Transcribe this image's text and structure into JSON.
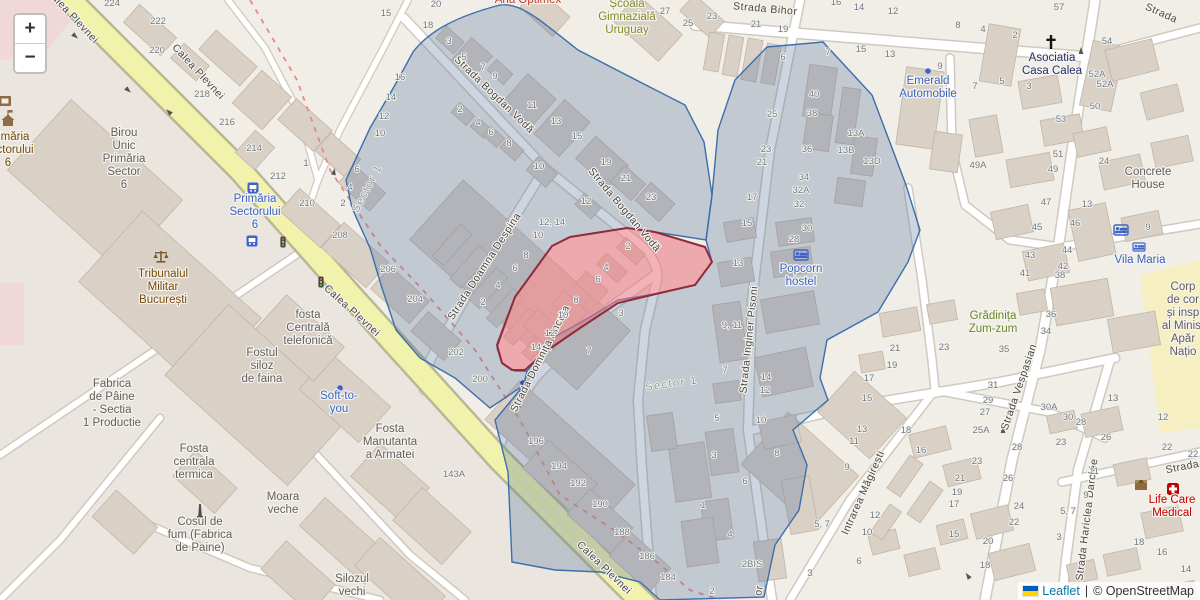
{
  "map": {
    "controls": {
      "zoom_in": "+",
      "zoom_out": "−"
    },
    "attribution": {
      "leaflet": "Leaflet",
      "separator": "|",
      "copyright": "© OpenStreetMap"
    }
  },
  "colors": {
    "selected_parcel_fill": "#e9737d",
    "selected_parcel_stroke": "#8f2b3c",
    "district_overlay_fill": "#5a739b",
    "district_overlay_stroke": "#3b6fad",
    "primary_road": "#f1f2ac",
    "link_blue": "#0078A8",
    "transit_label_blue": "#3a63c0",
    "amenity_label_brown": "#734a08",
    "health_label_red": "#bf0000"
  },
  "street_labels_format": "[text, x, y, rotation_deg]",
  "street_labels": [
    [
      "Calea Plevnei",
      70,
      18,
      47
    ],
    [
      "Calea Plevnei",
      196,
      74,
      47
    ],
    [
      "Calea Plevnei",
      350,
      313,
      42
    ],
    [
      "Calea Plevnei",
      602,
      570,
      44
    ],
    [
      "Strada Bogdan Vodă",
      492,
      97,
      44
    ],
    [
      "Strada Bogdan Vodă",
      622,
      212,
      50
    ],
    [
      "Strada Doamna Despina",
      487,
      268,
      -57
    ],
    [
      "Strada Domnița Ancuța",
      543,
      360,
      -63
    ],
    [
      "Strada Inginer Pisoni",
      752,
      340,
      -84
    ],
    [
      "Strada Bihor",
      765,
      12,
      5
    ],
    [
      "Intrarea Măgirești",
      866,
      494,
      -66
    ],
    [
      "Strada Vespasian",
      1022,
      388,
      -71
    ],
    [
      "Strada Hariclea Darclée",
      1090,
      520,
      -83
    ],
    [
      "Strada",
      1160,
      16,
      24
    ],
    [
      "Strada",
      1183,
      470,
      -11
    ],
    [
      "or",
      762,
      591,
      -80
    ]
  ],
  "area_labels_format": "[text, x, y, rotation_deg]",
  "area_labels": [
    [
      "Sector 1",
      370,
      190,
      -62
    ],
    [
      "Sector 1",
      672,
      387,
      -8
    ]
  ],
  "house_numbers_format": "[text, x, y]",
  "house_numbers": [
    [
      "224",
      112,
      6
    ],
    [
      "222",
      158,
      24
    ],
    [
      "220",
      157,
      53
    ],
    [
      "218",
      202,
      97
    ],
    [
      "216",
      227,
      125
    ],
    [
      "214",
      254,
      151
    ],
    [
      "212",
      278,
      179
    ],
    [
      "210",
      307,
      206
    ],
    [
      "208",
      340,
      238
    ],
    [
      "206",
      388,
      272
    ],
    [
      "204",
      415,
      302
    ],
    [
      "202",
      456,
      355
    ],
    [
      "200",
      480,
      382
    ],
    [
      "196",
      536,
      444
    ],
    [
      "194",
      559,
      469
    ],
    [
      "192",
      578,
      486
    ],
    [
      "190",
      600,
      507
    ],
    [
      "188",
      622,
      535
    ],
    [
      "186",
      647,
      559
    ],
    [
      "184",
      668,
      580
    ],
    [
      "15",
      386,
      16
    ],
    [
      "18",
      428,
      28
    ],
    [
      "20",
      436,
      7
    ],
    [
      "16",
      400,
      80
    ],
    [
      "14",
      391,
      100
    ],
    [
      "12",
      384,
      119
    ],
    [
      "10",
      380,
      136
    ],
    [
      "1",
      306,
      166
    ],
    [
      "6",
      357,
      172
    ],
    [
      "4",
      350,
      190
    ],
    [
      "2",
      343,
      206
    ],
    [
      "3",
      449,
      44
    ],
    [
      "5",
      464,
      60
    ],
    [
      "7",
      483,
      70
    ],
    [
      "9",
      495,
      79
    ],
    [
      "11",
      532,
      108
    ],
    [
      "13",
      556,
      124
    ],
    [
      "15",
      577,
      139
    ],
    [
      "19",
      606,
      165
    ],
    [
      "21",
      626,
      181
    ],
    [
      "23",
      651,
      200
    ],
    [
      "2",
      460,
      112
    ],
    [
      "4",
      478,
      125
    ],
    [
      "6",
      491,
      135
    ],
    [
      "8",
      509,
      146
    ],
    [
      "10",
      539,
      169
    ],
    [
      "12",
      586,
      204
    ],
    [
      "12, 14",
      552,
      225
    ],
    [
      "10",
      538,
      238
    ],
    [
      "8",
      526,
      258
    ],
    [
      "6",
      515,
      271
    ],
    [
      "4",
      498,
      288
    ],
    [
      "2",
      483,
      305
    ],
    [
      "2",
      628,
      249
    ],
    [
      "4",
      606,
      270
    ],
    [
      "6",
      598,
      282
    ],
    [
      "8",
      576,
      303
    ],
    [
      "10",
      563,
      318
    ],
    [
      "12",
      550,
      336
    ],
    [
      "14",
      536,
      350
    ],
    [
      "3",
      621,
      316
    ],
    [
      "7",
      589,
      354
    ],
    [
      "27",
      665,
      14
    ],
    [
      "25",
      688,
      26
    ],
    [
      "23",
      712,
      19
    ],
    [
      "21",
      756,
      27
    ],
    [
      "19",
      783,
      32
    ],
    [
      "16",
      836,
      5
    ],
    [
      "14",
      859,
      10
    ],
    [
      "12",
      893,
      14
    ],
    [
      "8",
      958,
      28
    ],
    [
      "4",
      983,
      32
    ],
    [
      "2",
      1015,
      38
    ],
    [
      "57",
      1059,
      10
    ],
    [
      "54",
      1107,
      44
    ],
    [
      "6",
      783,
      60
    ],
    [
      "7",
      828,
      55
    ],
    [
      "15",
      861,
      52
    ],
    [
      "13",
      890,
      57
    ],
    [
      "9",
      940,
      69
    ],
    [
      "7",
      975,
      89
    ],
    [
      "5",
      1002,
      84
    ],
    [
      "3",
      1029,
      89
    ],
    [
      "40",
      814,
      97
    ],
    [
      "38",
      812,
      116
    ],
    [
      "25",
      772,
      117
    ],
    [
      "23",
      766,
      152
    ],
    [
      "21",
      762,
      165
    ],
    [
      "17",
      752,
      200
    ],
    [
      "15",
      747,
      226
    ],
    [
      "13",
      738,
      266
    ],
    [
      "36",
      807,
      152
    ],
    [
      "34",
      804,
      180
    ],
    [
      "32A",
      801,
      193
    ],
    [
      "32",
      799,
      207
    ],
    [
      "30",
      807,
      231
    ],
    [
      "28",
      794,
      242
    ],
    [
      "13A",
      856,
      136
    ],
    [
      "13B",
      846,
      153
    ],
    [
      "13D",
      872,
      164
    ],
    [
      "49A",
      978,
      168
    ],
    [
      "52A",
      1097,
      77
    ],
    [
      "52A",
      1105,
      87
    ],
    [
      "50",
      1095,
      109
    ],
    [
      "53",
      1061,
      122
    ],
    [
      "51",
      1058,
      157
    ],
    [
      "49",
      1053,
      172
    ],
    [
      "47",
      1046,
      205
    ],
    [
      "46",
      1075,
      226
    ],
    [
      "13",
      1087,
      207
    ],
    [
      "24",
      1104,
      164
    ],
    [
      "45",
      1037,
      230
    ],
    [
      "43",
      1030,
      258
    ],
    [
      "41",
      1025,
      276
    ],
    [
      "44",
      1067,
      253
    ],
    [
      "42",
      1063,
      269
    ],
    [
      "38",
      1060,
      278
    ],
    [
      "36",
      1051,
      317
    ],
    [
      "34",
      1046,
      334
    ],
    [
      "9",
      1148,
      230
    ],
    [
      "35",
      1004,
      352
    ],
    [
      "30A",
      1049,
      410
    ],
    [
      "30",
      1068,
      420
    ],
    [
      "28",
      1081,
      425
    ],
    [
      "13",
      1113,
      401
    ],
    [
      "12",
      1163,
      420
    ],
    [
      "9, 11",
      732,
      328
    ],
    [
      "7",
      725,
      373
    ],
    [
      "5",
      717,
      421
    ],
    [
      "14",
      766,
      380
    ],
    [
      "12",
      765,
      393
    ],
    [
      "10",
      761,
      423
    ],
    [
      "21",
      895,
      351
    ],
    [
      "19",
      892,
      368
    ],
    [
      "17",
      869,
      381
    ],
    [
      "15",
      867,
      401
    ],
    [
      "23",
      944,
      350
    ],
    [
      "31",
      993,
      388
    ],
    [
      "29",
      988,
      403
    ],
    [
      "27",
      985,
      415
    ],
    [
      "3",
      714,
      458
    ],
    [
      "8",
      777,
      456
    ],
    [
      "6",
      745,
      484
    ],
    [
      "1",
      703,
      508
    ],
    [
      "4",
      730,
      537
    ],
    [
      "2BIS",
      752,
      567
    ],
    [
      "2",
      712,
      594
    ],
    [
      "5, 7",
      822,
      527
    ],
    [
      "13",
      862,
      432
    ],
    [
      "11",
      854,
      444
    ],
    [
      "9",
      847,
      470
    ],
    [
      "12",
      875,
      518
    ],
    [
      "10",
      867,
      535
    ],
    [
      "6",
      859,
      564
    ],
    [
      "3",
      810,
      576
    ],
    [
      "25A",
      981,
      433
    ],
    [
      "23",
      977,
      464
    ],
    [
      "21",
      960,
      481
    ],
    [
      "19",
      957,
      495
    ],
    [
      "17",
      954,
      507
    ],
    [
      "15",
      954,
      537
    ],
    [
      "18",
      906,
      433
    ],
    [
      "16",
      921,
      453
    ],
    [
      "20",
      988,
      544
    ],
    [
      "18",
      985,
      568
    ],
    [
      "28",
      1017,
      450
    ],
    [
      "26",
      1008,
      481
    ],
    [
      "24",
      1019,
      509
    ],
    [
      "22",
      1014,
      525
    ],
    [
      "26",
      1106,
      440
    ],
    [
      "23",
      1061,
      445
    ],
    [
      "11",
      1094,
      474
    ],
    [
      "9",
      1086,
      498
    ],
    [
      "5, 7",
      1068,
      514
    ],
    [
      "3",
      1059,
      540
    ],
    [
      "22",
      1167,
      450
    ],
    [
      "22",
      1193,
      457
    ],
    [
      "18",
      1139,
      545
    ],
    [
      "16",
      1162,
      555
    ],
    [
      "14",
      1186,
      572
    ],
    [
      "143A",
      454,
      477
    ]
  ],
  "poi_labels_format": "{n:name, x, y:first_baseline, c:color, lines[], lh:line_height}",
  "poi_labels": [
    {
      "n": "primaria-sectorului-6-hall",
      "x": 8,
      "y": 140,
      "c": "#734a08",
      "lh": 13,
      "lines": [
        "Primăria",
        "Sectorului",
        "6"
      ]
    },
    {
      "n": "birou-unic-primaria",
      "x": 124,
      "y": 136,
      "c": "#5f5f5f",
      "lh": 13,
      "lines": [
        "Birou",
        "Unic",
        "Primăria",
        "Sector",
        "6"
      ]
    },
    {
      "n": "primaria-sectorului-6-stop",
      "x": 255,
      "y": 202,
      "c": "#3a63c0",
      "lh": 13,
      "lines": [
        "Primăria",
        "Sectorului",
        "6"
      ]
    },
    {
      "n": "tribunalul-militar",
      "x": 163,
      "y": 277,
      "c": "#734a08",
      "lh": 13,
      "lines": [
        "Tribunalul",
        "Militar",
        "București"
      ]
    },
    {
      "n": "fabrica-de-paine",
      "x": 112,
      "y": 387,
      "c": "#5f5f5f",
      "lh": 13,
      "lines": [
        "Fabrica",
        "de Pâine",
        "- Sectia",
        "1 Productie"
      ]
    },
    {
      "n": "fostul-siloz",
      "x": 262,
      "y": 356,
      "c": "#5f5f5f",
      "lh": 13,
      "lines": [
        "Fostul",
        "siloz",
        "de faina"
      ]
    },
    {
      "n": "fosta-centrala-telefonica",
      "x": 308,
      "y": 318,
      "c": "#5f5f5f",
      "lh": 13,
      "lines": [
        "fosta",
        "Centrală",
        "telefonică"
      ]
    },
    {
      "n": "soft-to-you",
      "x": 339,
      "y": 399,
      "c": "#3a63c0",
      "lh": 13,
      "lines": [
        "Soft-to-",
        "you"
      ]
    },
    {
      "n": "fosta-manutanta",
      "x": 390,
      "y": 432,
      "c": "#5f5f5f",
      "lh": 13,
      "lines": [
        "Fosta",
        "Manutanta",
        "a Armatei"
      ]
    },
    {
      "n": "fosta-centrala-termica",
      "x": 194,
      "y": 452,
      "c": "#5f5f5f",
      "lh": 13,
      "lines": [
        "Fosta",
        "centrala",
        "termica"
      ]
    },
    {
      "n": "cosul-de-fum",
      "x": 200,
      "y": 525,
      "c": "#5f5f5f",
      "lh": 13,
      "lines": [
        "Cosul de",
        "fum (Fabrica",
        "de Paine)"
      ]
    },
    {
      "n": "moara-veche",
      "x": 283,
      "y": 500,
      "c": "#5f5f5f",
      "lh": 13,
      "lines": [
        "Moara",
        "veche"
      ]
    },
    {
      "n": "silozul-vechi",
      "x": 352,
      "y": 582,
      "c": "#5f5f5f",
      "lh": 13,
      "lines": [
        "Silozul",
        "vechi"
      ]
    },
    {
      "n": "scoala-gimnaziala-uruguay",
      "x": 627,
      "y": 7,
      "c": "#7f8c2b",
      "lh": 13,
      "lines": [
        "Școală",
        "Gimnazială",
        "Uruguay"
      ]
    },
    {
      "n": "ana-optimex",
      "x": 528,
      "y": 3,
      "c": "#c0392b",
      "lh": 12,
      "lines": [
        "Ana Optimex"
      ]
    },
    {
      "n": "emerald-automobile",
      "x": 928,
      "y": 84,
      "c": "#3a63c0",
      "lh": 13,
      "lines": [
        "Emerald",
        "Automobile"
      ]
    },
    {
      "n": "asociatia-casa-calea",
      "x": 1052,
      "y": 61,
      "c": "#23306b",
      "lh": 13,
      "lines": [
        "Asociatia",
        "Casa Calea"
      ]
    },
    {
      "n": "concrete-house",
      "x": 1148,
      "y": 175,
      "c": "#5f5f5f",
      "lh": 13,
      "lines": [
        "Concrete",
        "House"
      ]
    },
    {
      "n": "popcorn-hostel",
      "x": 801,
      "y": 272,
      "c": "#3a63c0",
      "lh": 13,
      "lines": [
        "Popcorn",
        "hostel"
      ]
    },
    {
      "n": "gradinita-zum-zum",
      "x": 993,
      "y": 319,
      "c": "#68862b",
      "lh": 13,
      "lines": [
        "Grădinița",
        "Zum-zum"
      ]
    },
    {
      "n": "vila-maria",
      "x": 1140,
      "y": 263,
      "c": "#3a63c0",
      "lh": 13,
      "lines": [
        "Vila Maria"
      ]
    },
    {
      "n": "corpul-de-control",
      "x": 1183,
      "y": 290,
      "c": "#5f5f5f",
      "lh": 13,
      "lines": [
        "Corp",
        "de cor",
        "și insp",
        "al Minist",
        "Apăr",
        "Națio"
      ]
    },
    {
      "n": "life-care-medical",
      "x": 1172,
      "y": 503,
      "c": "#bf0000",
      "lh": 13,
      "lines": [
        "Life Care",
        "Medical"
      ]
    }
  ]
}
